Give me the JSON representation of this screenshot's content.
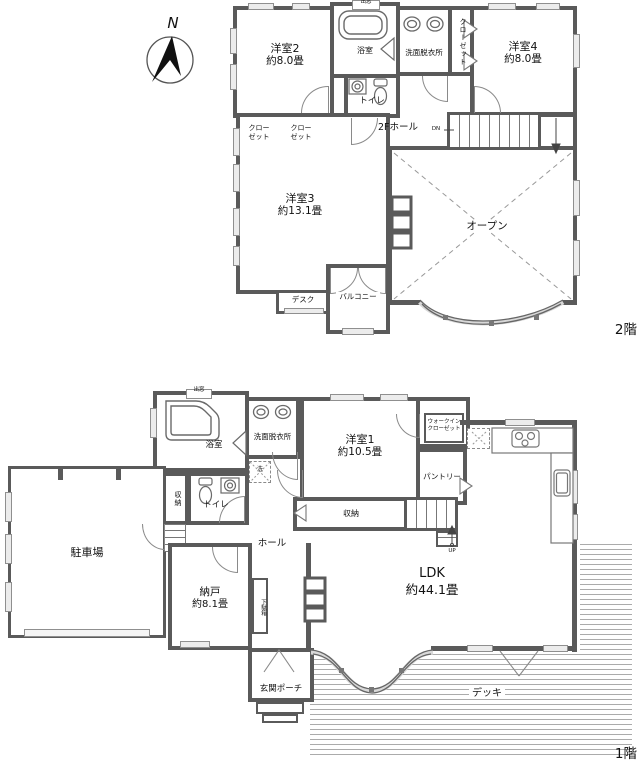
{
  "compass": {
    "north": "N"
  },
  "colors": {
    "wall": "#5a5a5a",
    "line": "#8a8a8a",
    "window_fill": "#ececec",
    "deck_stripe": "#ababab",
    "text": "#111111"
  },
  "floor2": {
    "floor_label": "2階",
    "yoshitsu2_name": "洋室2",
    "yoshitsu2_size": "約8.0畳",
    "bath": "浴室",
    "bath_baywindow": "出窓",
    "senmen": "洗面脱衣所",
    "closet_tall": "クローゼット",
    "yoshitsu4_name": "洋室4",
    "yoshitsu4_size": "約8.0畳",
    "toilet": "トイレ",
    "closet_a_l1": "クロー",
    "closet_a_l2": "ゼット",
    "closet_b_l1": "クロー",
    "closet_b_l2": "ゼット",
    "hall": "2Fホール",
    "dn": "DN",
    "yoshitsu3_name": "洋室3",
    "yoshitsu3_size": "約13.1畳",
    "desk": "デスク",
    "balcony": "バルコニー",
    "open": "オープン"
  },
  "floor1": {
    "floor_label": "1階",
    "bath": "浴室",
    "bath_baywindow": "出窓",
    "senmen": "洗面脱衣所",
    "washer": "洗",
    "toilet": "トイレ",
    "storage_wc": "収納",
    "storage_hall": "収納",
    "yoshitsu1_name": "洋室1",
    "yoshitsu1_size": "約10.5畳",
    "wic_l1": "ウォークイン",
    "wic_l2": "クローゼット",
    "pantry": "パントリー",
    "up": "UP",
    "hall": "ホール",
    "parking": "駐車場",
    "nando_name": "納戸",
    "nando_size": "約8.1畳",
    "shoe_cabinet": "下駄箱",
    "porch": "玄関ポーチ",
    "ldk_name": "LDK",
    "ldk_size": "約44.1畳",
    "deck": "デッキ"
  }
}
